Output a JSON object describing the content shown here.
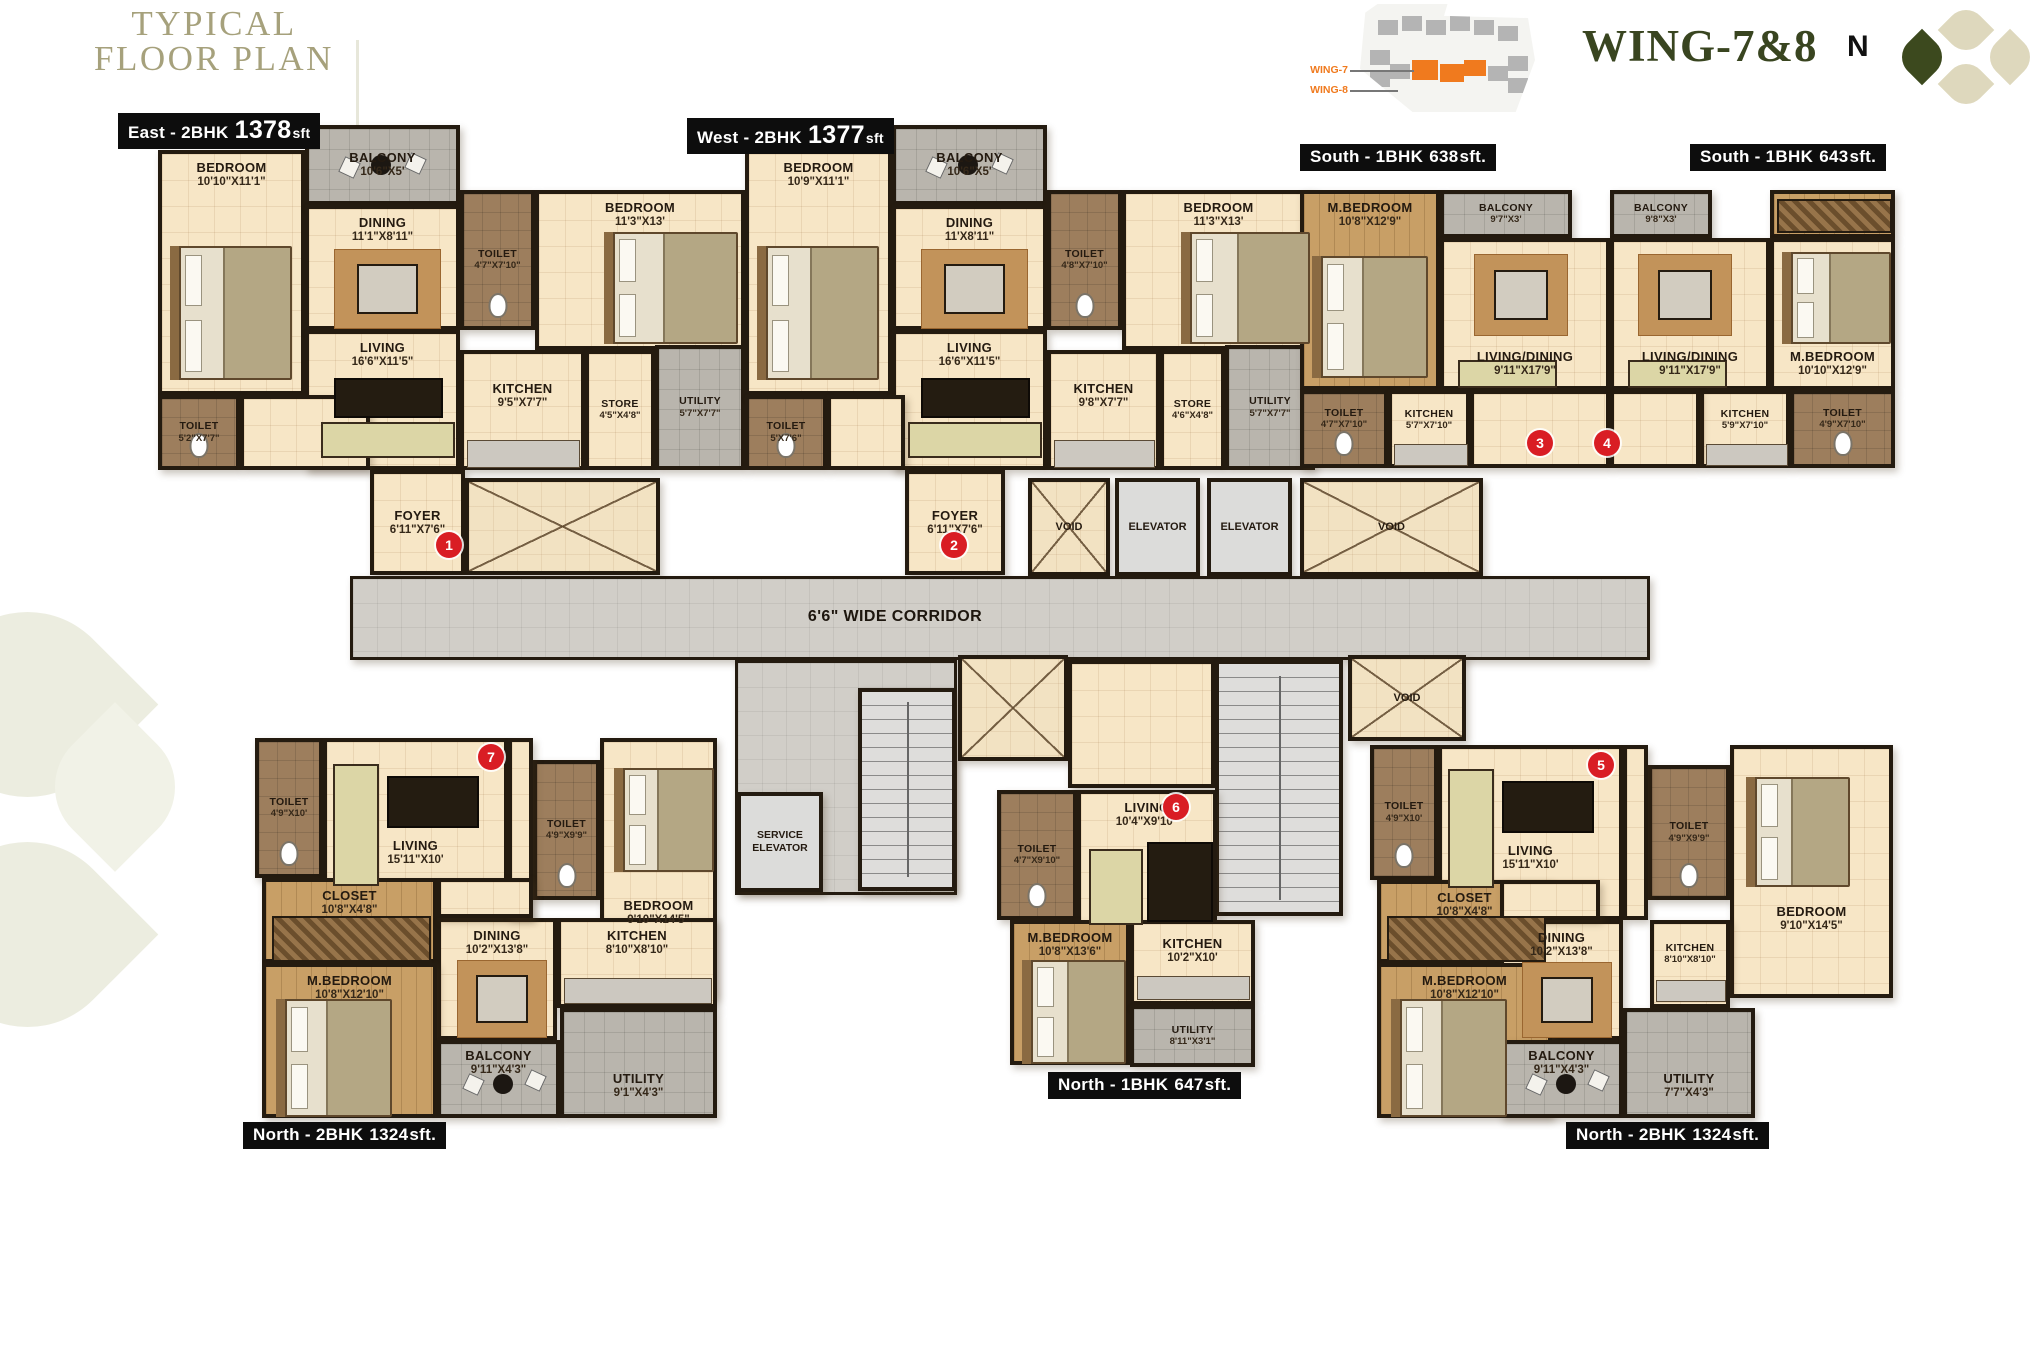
{
  "header": {
    "title_line1": "TYPICAL",
    "title_line2": "FLOOR PLAN",
    "wing_title": "WING-7&8",
    "compass_label": "N",
    "keyplan": {
      "wing7": "WING-7",
      "wing8": "WING-8"
    }
  },
  "core": {
    "corridor": "6'6\" WIDE CORRIDOR",
    "elevator": "ELEVATOR",
    "service_elevator": "SERVICE ELEVATOR",
    "void": "VOID"
  },
  "colors": {
    "accent_orange": "#F07A1E",
    "brand_green": "#394520",
    "title_olive": "#A6A17C",
    "marker_red": "#D91D24",
    "wall": "#241B10",
    "floor_cream": "#F7E6C6",
    "balcony_gray": "#B9B5AD",
    "toilet_brown": "#9D7E5D",
    "wood_tan": "#C89F66"
  },
  "units": {
    "east": {
      "badge": {
        "name": "East - 2BHK",
        "area": "1378",
        "suffix": "sft"
      },
      "marker": "1",
      "rooms": [
        {
          "name": "BEDROOM",
          "dims": "10'10\"X11'1\""
        },
        {
          "name": "BALCONY",
          "dims": "10'6\"X5'"
        },
        {
          "name": "DINING",
          "dims": "11'1\"X8'11\""
        },
        {
          "name": "TOILET",
          "dims": "4'7\"X7'10\""
        },
        {
          "name": "BEDROOM",
          "dims": "11'3\"X13'"
        },
        {
          "name": "LIVING",
          "dims": "16'6\"X11'5\""
        },
        {
          "name": "TOILET",
          "dims": "5'2\"X7'7\""
        },
        {
          "name": "FOYER",
          "dims": "6'11\"X7'6\""
        },
        {
          "name": "KITCHEN",
          "dims": "9'5\"X7'7\""
        },
        {
          "name": "STORE",
          "dims": "4'5\"X4'8\""
        },
        {
          "name": "UTILITY",
          "dims": "5'7\"X7'7\""
        }
      ]
    },
    "west": {
      "badge": {
        "name": "West - 2BHK",
        "area": "1377",
        "suffix": "sft"
      },
      "marker": "2",
      "rooms": [
        {
          "name": "BEDROOM",
          "dims": "10'9\"X11'1\""
        },
        {
          "name": "BALCONY",
          "dims": "10'6\"X5'"
        },
        {
          "name": "DINING",
          "dims": "11'X8'11\""
        },
        {
          "name": "TOILET",
          "dims": "4'8\"X7'10\""
        },
        {
          "name": "BEDROOM",
          "dims": "11'3\"X13'"
        },
        {
          "name": "LIVING",
          "dims": "16'6\"X11'5\""
        },
        {
          "name": "TOILET",
          "dims": "5'X7'6\""
        },
        {
          "name": "FOYER",
          "dims": "6'11\"X7'6\""
        },
        {
          "name": "KITCHEN",
          "dims": "9'8\"X7'7\""
        },
        {
          "name": "STORE",
          "dims": "4'6\"X4'8\""
        },
        {
          "name": "UTILITY",
          "dims": "5'7\"X7'7\""
        }
      ]
    },
    "south638": {
      "badge": {
        "name": "South - 1BHK",
        "area": "638",
        "suffix": "sft."
      },
      "marker": "3",
      "rooms": [
        {
          "name": "M.BEDROOM",
          "dims": "10'8\"X12'9\""
        },
        {
          "name": "BALCONY",
          "dims": "9'7\"X3'"
        },
        {
          "name": "LIVING/DINING",
          "dims": "9'11\"X17'9\""
        },
        {
          "name": "TOILET",
          "dims": "4'7\"X7'10\""
        },
        {
          "name": "KITCHEN",
          "dims": "5'7\"X7'10\""
        }
      ]
    },
    "south643": {
      "badge": {
        "name": "South - 1BHK",
        "area": "643",
        "suffix": "sft."
      },
      "marker": "4",
      "rooms": [
        {
          "name": "BALCONY",
          "dims": "9'8\"X3'"
        },
        {
          "name": "LIVING/DINING",
          "dims": "9'11\"X17'9\""
        },
        {
          "name": "M.BEDROOM",
          "dims": "10'10\"X12'9\""
        },
        {
          "name": "KITCHEN",
          "dims": "5'9\"X7'10\""
        },
        {
          "name": "TOILET",
          "dims": "4'9\"X7'10\""
        }
      ]
    },
    "north_left": {
      "badge": {
        "name": "North - 2BHK",
        "area": "1324",
        "suffix": "sft."
      },
      "marker": "7",
      "rooms": [
        {
          "name": "TOILET",
          "dims": "4'9\"X10'"
        },
        {
          "name": "LIVING",
          "dims": "15'11\"X10'"
        },
        {
          "name": "TOILET",
          "dims": "4'9\"X9'9\""
        },
        {
          "name": "BEDROOM",
          "dims": "9'10\"X14'5\""
        },
        {
          "name": "CLOSET",
          "dims": "10'8\"X4'8\""
        },
        {
          "name": "DINING",
          "dims": "10'2\"X13'8\""
        },
        {
          "name": "M.BEDROOM",
          "dims": "10'8\"X12'10\""
        },
        {
          "name": "KITCHEN",
          "dims": "8'10\"X8'10\""
        },
        {
          "name": "BALCONY",
          "dims": "9'11\"X4'3\""
        },
        {
          "name": "UTILITY",
          "dims": "9'1\"X4'3\""
        }
      ]
    },
    "north_mid": {
      "badge": {
        "name": "North - 1BHK",
        "area": "647",
        "suffix": "sft."
      },
      "marker": "6",
      "rooms": [
        {
          "name": "TOILET",
          "dims": "4'7\"X9'10\""
        },
        {
          "name": "LIVING",
          "dims": "10'4\"X9'10\""
        },
        {
          "name": "M.BEDROOM",
          "dims": "10'8\"X13'6\""
        },
        {
          "name": "KITCHEN",
          "dims": "10'2\"X10'"
        },
        {
          "name": "UTILITY",
          "dims": "8'11\"X3'1\""
        }
      ]
    },
    "north_right": {
      "badge": {
        "name": "North - 2BHK",
        "area": "1324",
        "suffix": "sft."
      },
      "marker": "5",
      "rooms": [
        {
          "name": "TOILET",
          "dims": "4'9\"X10'"
        },
        {
          "name": "LIVING",
          "dims": "15'11\"X10'"
        },
        {
          "name": "TOILET",
          "dims": "4'9\"X9'9\""
        },
        {
          "name": "BEDROOM",
          "dims": "9'10\"X14'5\""
        },
        {
          "name": "CLOSET",
          "dims": "10'8\"X4'8\""
        },
        {
          "name": "DINING",
          "dims": "10'2\"X13'8\""
        },
        {
          "name": "M.BEDROOM",
          "dims": "10'8\"X12'10\""
        },
        {
          "name": "KITCHEN",
          "dims": "8'10\"X8'10\""
        },
        {
          "name": "BALCONY",
          "dims": "9'11\"X4'3\""
        },
        {
          "name": "UTILITY",
          "dims": "7'7\"X4'3\""
        }
      ]
    }
  }
}
